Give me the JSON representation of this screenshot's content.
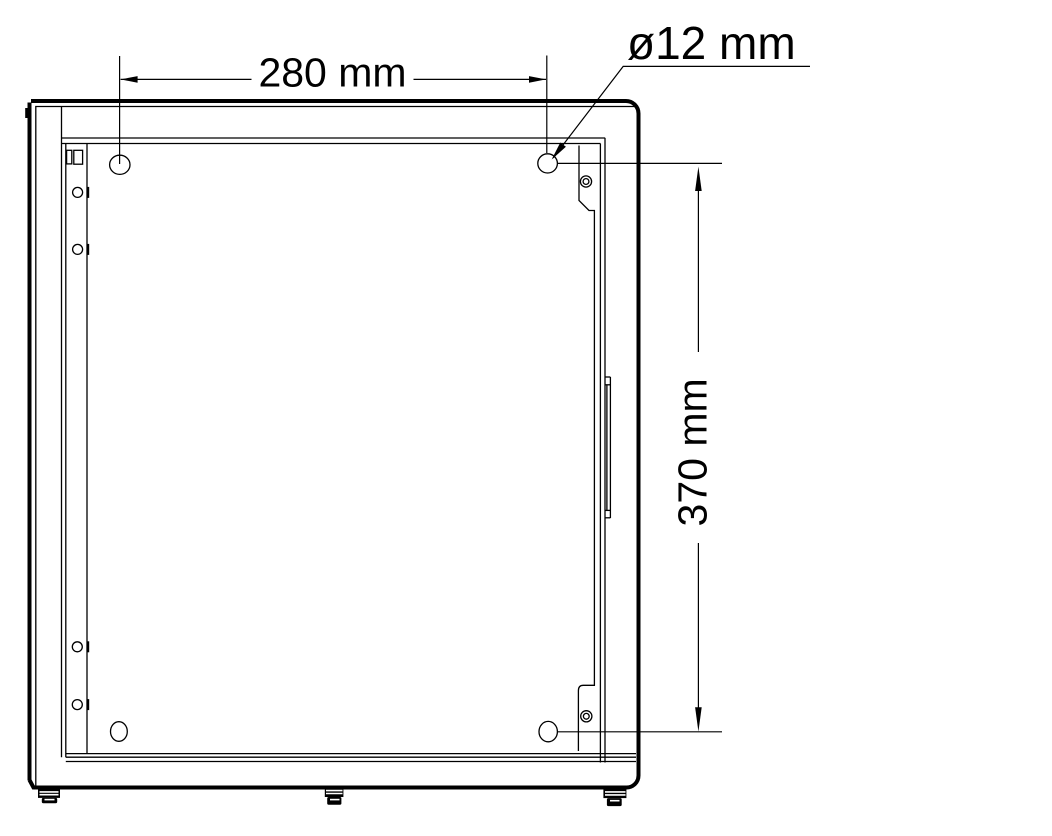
{
  "page": {
    "background": "#ffffff",
    "line_color": "#000000"
  },
  "drawing": {
    "kind": "technical-dimension-drawing",
    "subject": "enclosure rear panel with mounting holes",
    "labels": {
      "hole_spacing_horizontal": "280 mm",
      "hole_diameter": "ø12 mm",
      "hole_spacing_vertical": "370 mm"
    }
  }
}
